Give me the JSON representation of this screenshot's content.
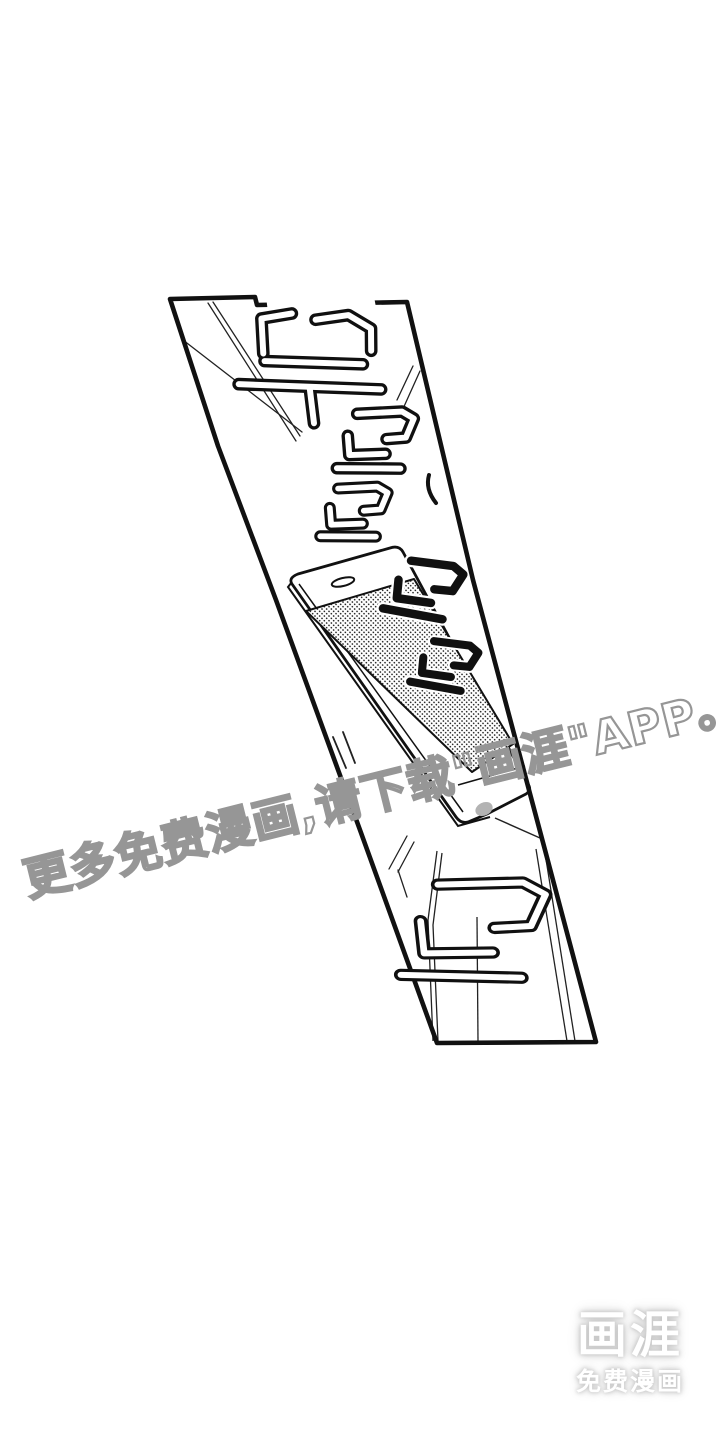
{
  "canvas": {
    "width": 720,
    "height": 1440,
    "background": "#ffffff",
    "ink_color": "#111111"
  },
  "panel": {
    "description": "slanted borderless-background comic panel: a smartphone with halftone screen lying on a table, ringing",
    "border_color": "#111111",
    "fill": "#ffffff",
    "screen_dot_color": "#1c1c1c"
  },
  "sfx": {
    "description": "Korean onomatopoeia of a phone ringing",
    "items": [
      {
        "text": "뚜",
        "style": "outline"
      },
      {
        "text": "르",
        "style": "outline"
      },
      {
        "text": "르",
        "style": "outline"
      },
      {
        "text": "르",
        "style": "solid"
      },
      {
        "text": "르",
        "style": "solid"
      },
      {
        "text": "르",
        "style": "outline"
      }
    ]
  },
  "watermark": {
    "text": "更多免费漫画,请下载\"画涯\"APP。",
    "stroke_color": "#969696"
  },
  "logo": {
    "title": "画涯",
    "subtitle": "免费漫画",
    "text_color": "#ffffff"
  }
}
